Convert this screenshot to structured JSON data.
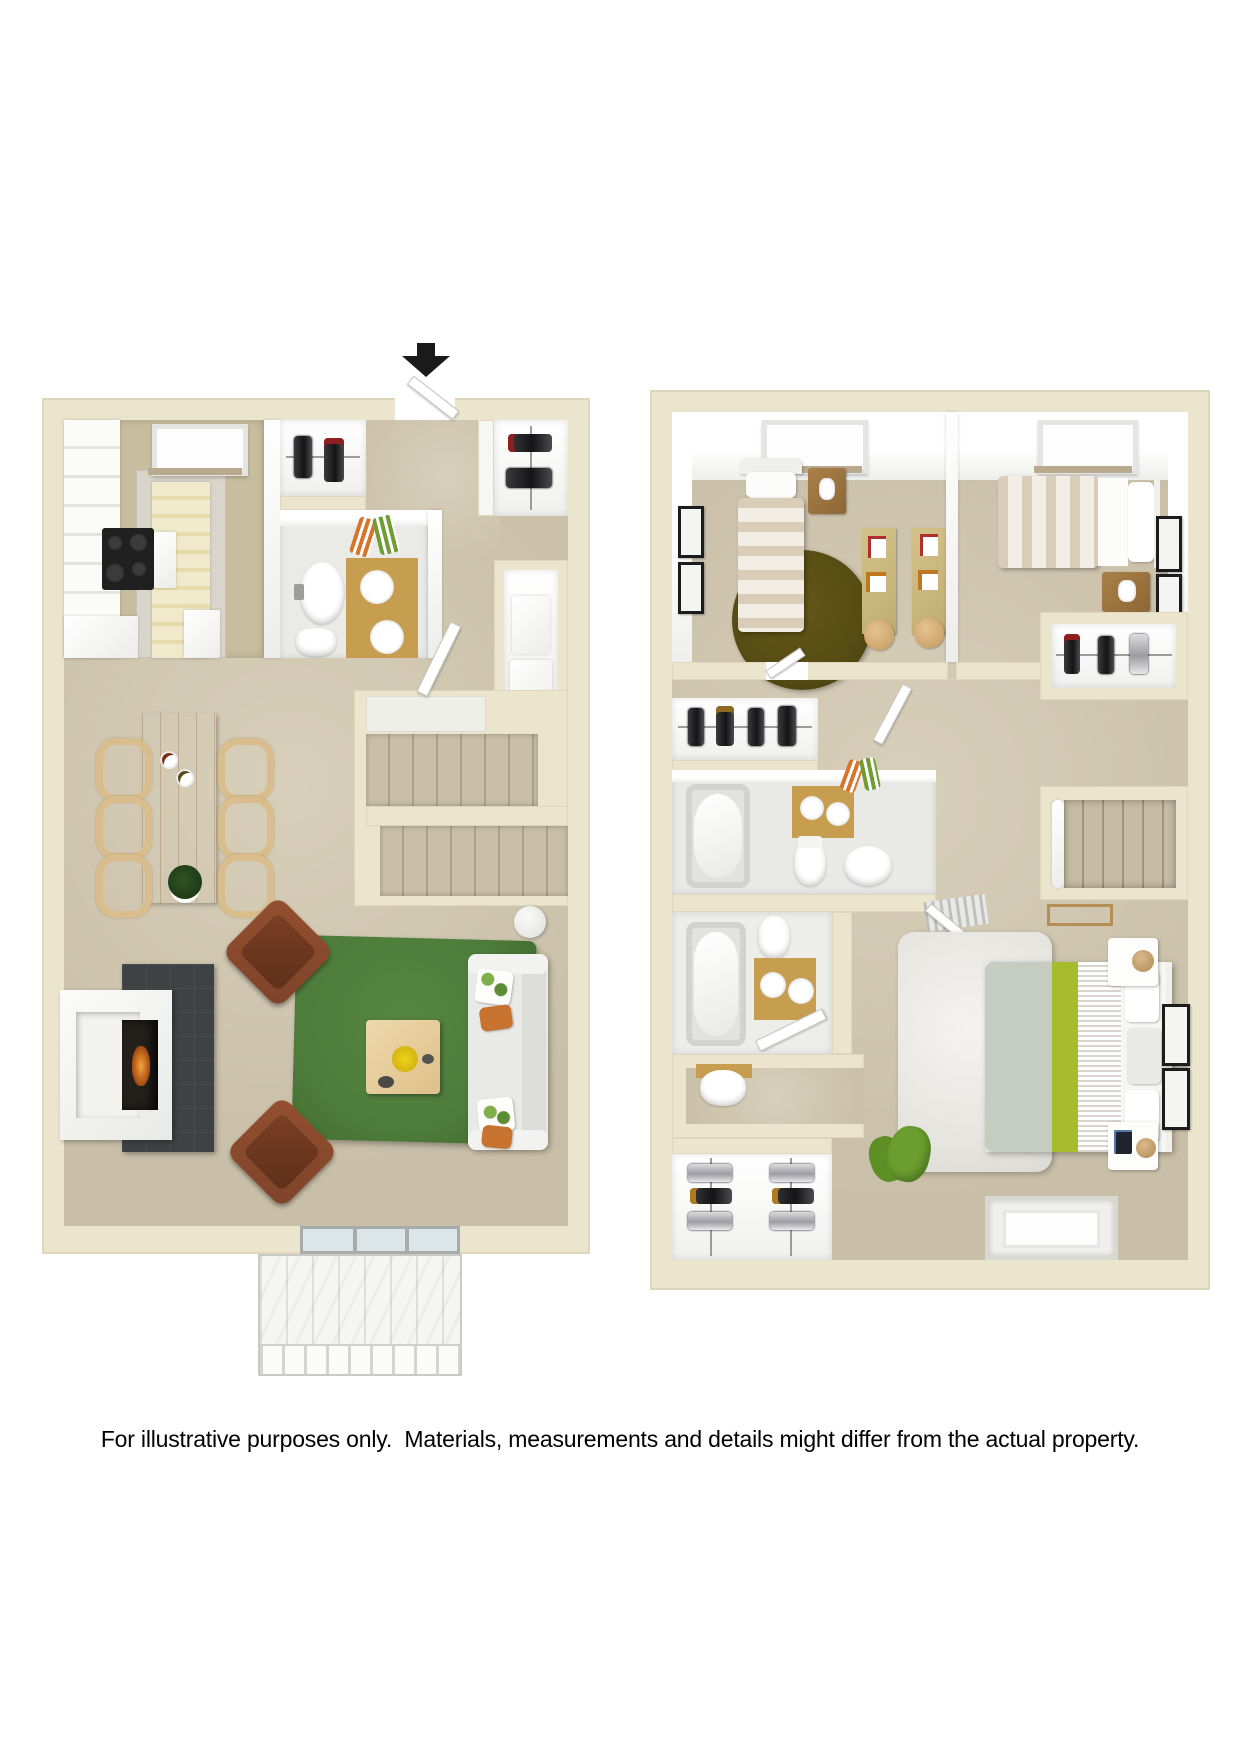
{
  "caption": "For illustrative purposes only.  Materials, measurements and details might differ from the actual property.",
  "plan": {
    "units": [
      {
        "name": "first-floor",
        "rooms": [
          "kitchen",
          "entry",
          "closet",
          "half-bathroom",
          "coat-closet",
          "stairs",
          "dining-area",
          "living-room",
          "fireplace",
          "deck"
        ]
      },
      {
        "name": "second-floor",
        "rooms": [
          "bedroom-1",
          "bedroom-2",
          "hall",
          "closet",
          "linen-closet",
          "bathroom-1",
          "bathroom-2",
          "water-closet",
          "walk-in-closet",
          "master-bedroom",
          "stairs"
        ]
      }
    ],
    "entry_marker": "down-arrow"
  },
  "colors": {
    "wall": "#ECE5CE",
    "wallDark": "#DFD7BB",
    "carpet": "#C9BFA8",
    "carpetLight": "#D8CFBA",
    "tileGray": "#D9D5CB",
    "tileTan": "#C9BD9F",
    "runner": "#F0E9CB",
    "wood": "#E2C894",
    "gold": "#C79E4F",
    "rugGreen": "#4E7D3B",
    "rugOlive": "#564C14",
    "chairBrown": "#7E432A",
    "sofaWhite": "#E9E9E7",
    "stoveBlack": "#202020",
    "firePanel": "#3F4245",
    "lime": "#A6BC2C",
    "sage": "#C5CDC2",
    "beanbagGreen": "#6B9E2E",
    "deck": "#F5F5F2",
    "glass": "#DCE6E8",
    "arrow": "#1A1A1A"
  }
}
